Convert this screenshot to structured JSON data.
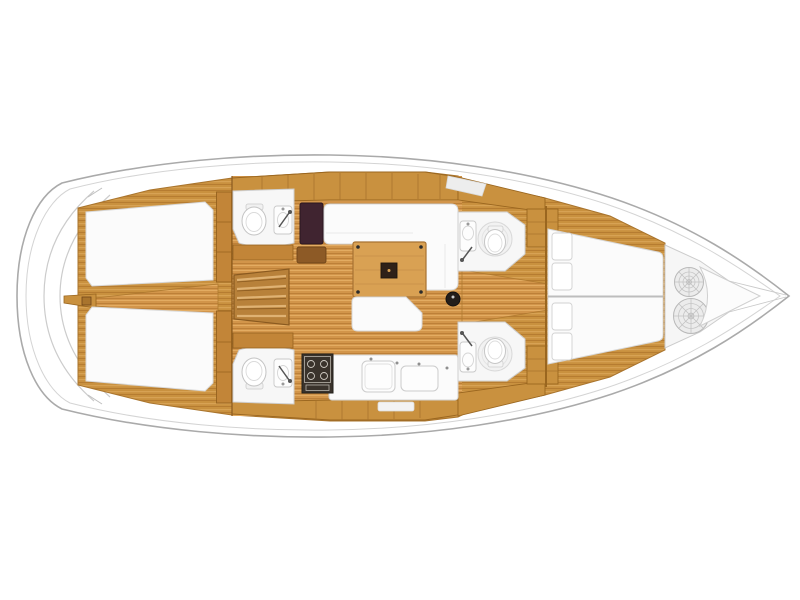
{
  "diagram": {
    "kind": "yacht-interior-floor-plan",
    "view": "top-down",
    "orientation": "bow-right-stern-left",
    "features": {
      "stern": [
        "transom-swim-platform-steps"
      ],
      "aft_cabins": [
        "port-aft-double-berth",
        "starboard-aft-double-berth",
        "central-corridor",
        "wardrobes"
      ],
      "heads": [
        "port-aft-head-toilet-sink-shower",
        "starboard-aft-head-toilet-sink-shower",
        "port-forward-head-toilet-sink-shower",
        "starboard-forward-head-toilet-sink-shower"
      ],
      "salon": [
        "companionway-stairs",
        "navigation-station",
        "l-shaped-settee",
        "salon-table",
        "bench-settee",
        "mast-post"
      ],
      "galley": [
        "stove-with-burners",
        "double-sink",
        "countertop"
      ],
      "forward": [
        "v-berth-forward-cabin",
        "berth-pillows",
        "anchor-locker",
        "mooring-rope-coils",
        "bow-peak"
      ]
    },
    "colors": {
      "background": "#ffffff",
      "hull_outline": "#aaaaaa",
      "deck_line": "#d4d4d4",
      "wood_base": "#c9913f",
      "wood_light": "#d7a254",
      "wood_dark": "#b67c31",
      "floor_base": "#d2954a",
      "floor_light": "#e3ac62",
      "floor_dark": "#bd8038",
      "cabinet_edge": "#9a661f",
      "white_surface": "#fbfbfb",
      "surface_edge": "#d6d6d6",
      "nav_table": "#402430",
      "stove": "#3a332c",
      "mast": "#241e1a"
    }
  }
}
